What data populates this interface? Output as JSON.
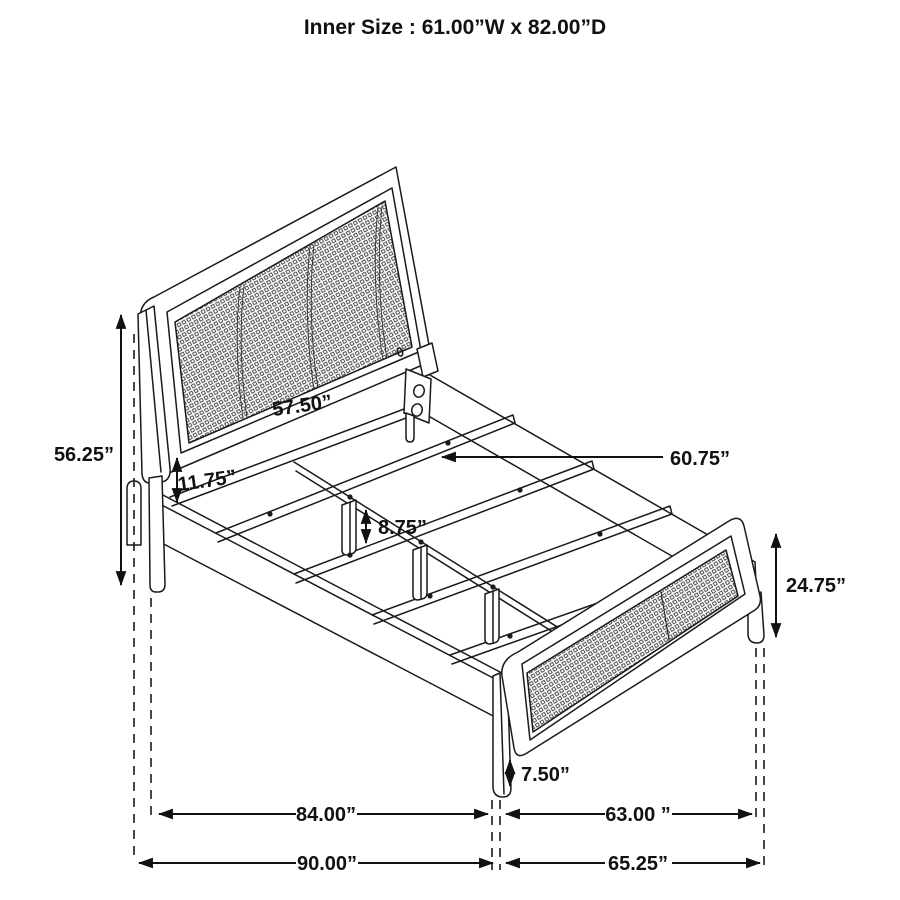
{
  "title": "Inner Size : 61.00”W x 82.00”D",
  "dims": {
    "headboard_height": "56.25”",
    "headboard_width": "57.50”",
    "headboard_to_rail_gap": "11.75”",
    "center_leg_height": "8.75”",
    "slat_length": "60.75”",
    "footboard_height": "24.75”",
    "footboard_leg_height": "7.50”",
    "inside_length": "84.00”",
    "footboard_inside_width": "63.00 ”",
    "overall_length": "90.00”",
    "footboard_overall_width": "65.25”"
  }
}
